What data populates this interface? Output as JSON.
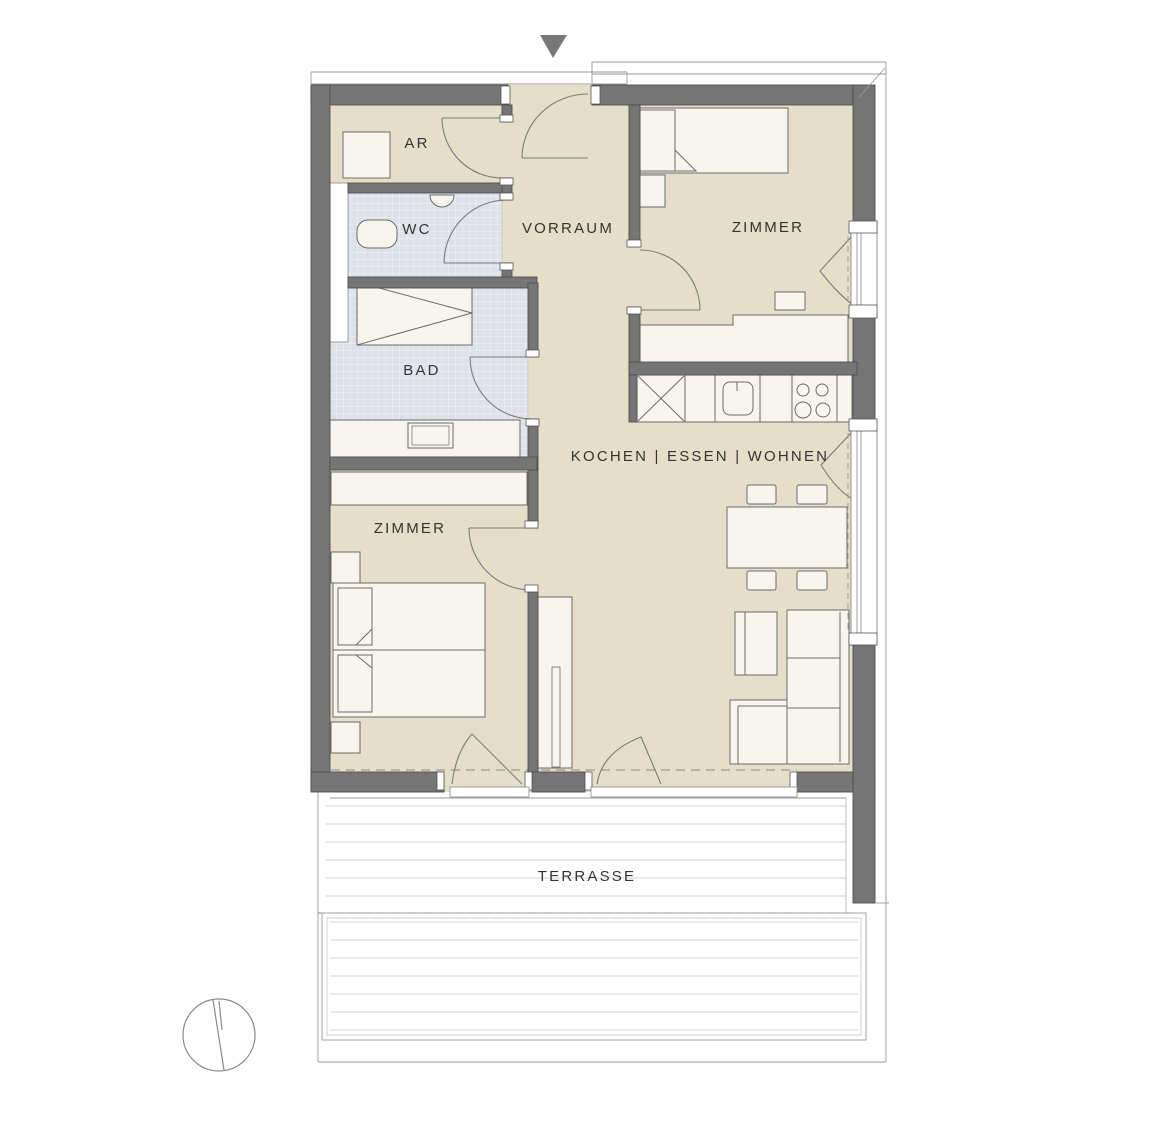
{
  "document": {
    "type": "apartment-floor-plan",
    "language": "de"
  },
  "rooms": {
    "ar": "AR",
    "wc": "WC",
    "bad": "BAD",
    "vorraum": "VORRAUM",
    "zimmer_top": "ZIMMER",
    "kochen_essen_wohnen": "KOCHEN | ESSEN | WOHNEN",
    "zimmer_bottom": "ZIMMER",
    "terrasse": "TERRASSE"
  },
  "icons": {
    "entrance_arrow": "entrance-direction-arrow",
    "north_indicator": "north-indicator-circle"
  },
  "colors": {
    "wall_fill": "#757575",
    "wall_outline": "#4f4f4f",
    "floor_beige": "#e5dec9",
    "tile_blue_gray": "#dde1e8",
    "furniture_fill": "#f7f5ee",
    "thin_line": "#9a9a9a",
    "deck_line": "#d5d5d5",
    "dashed_line": "#8a8a8a",
    "label_text": "#333333",
    "arrow_fill": "#787878",
    "background": "#ffffff"
  }
}
